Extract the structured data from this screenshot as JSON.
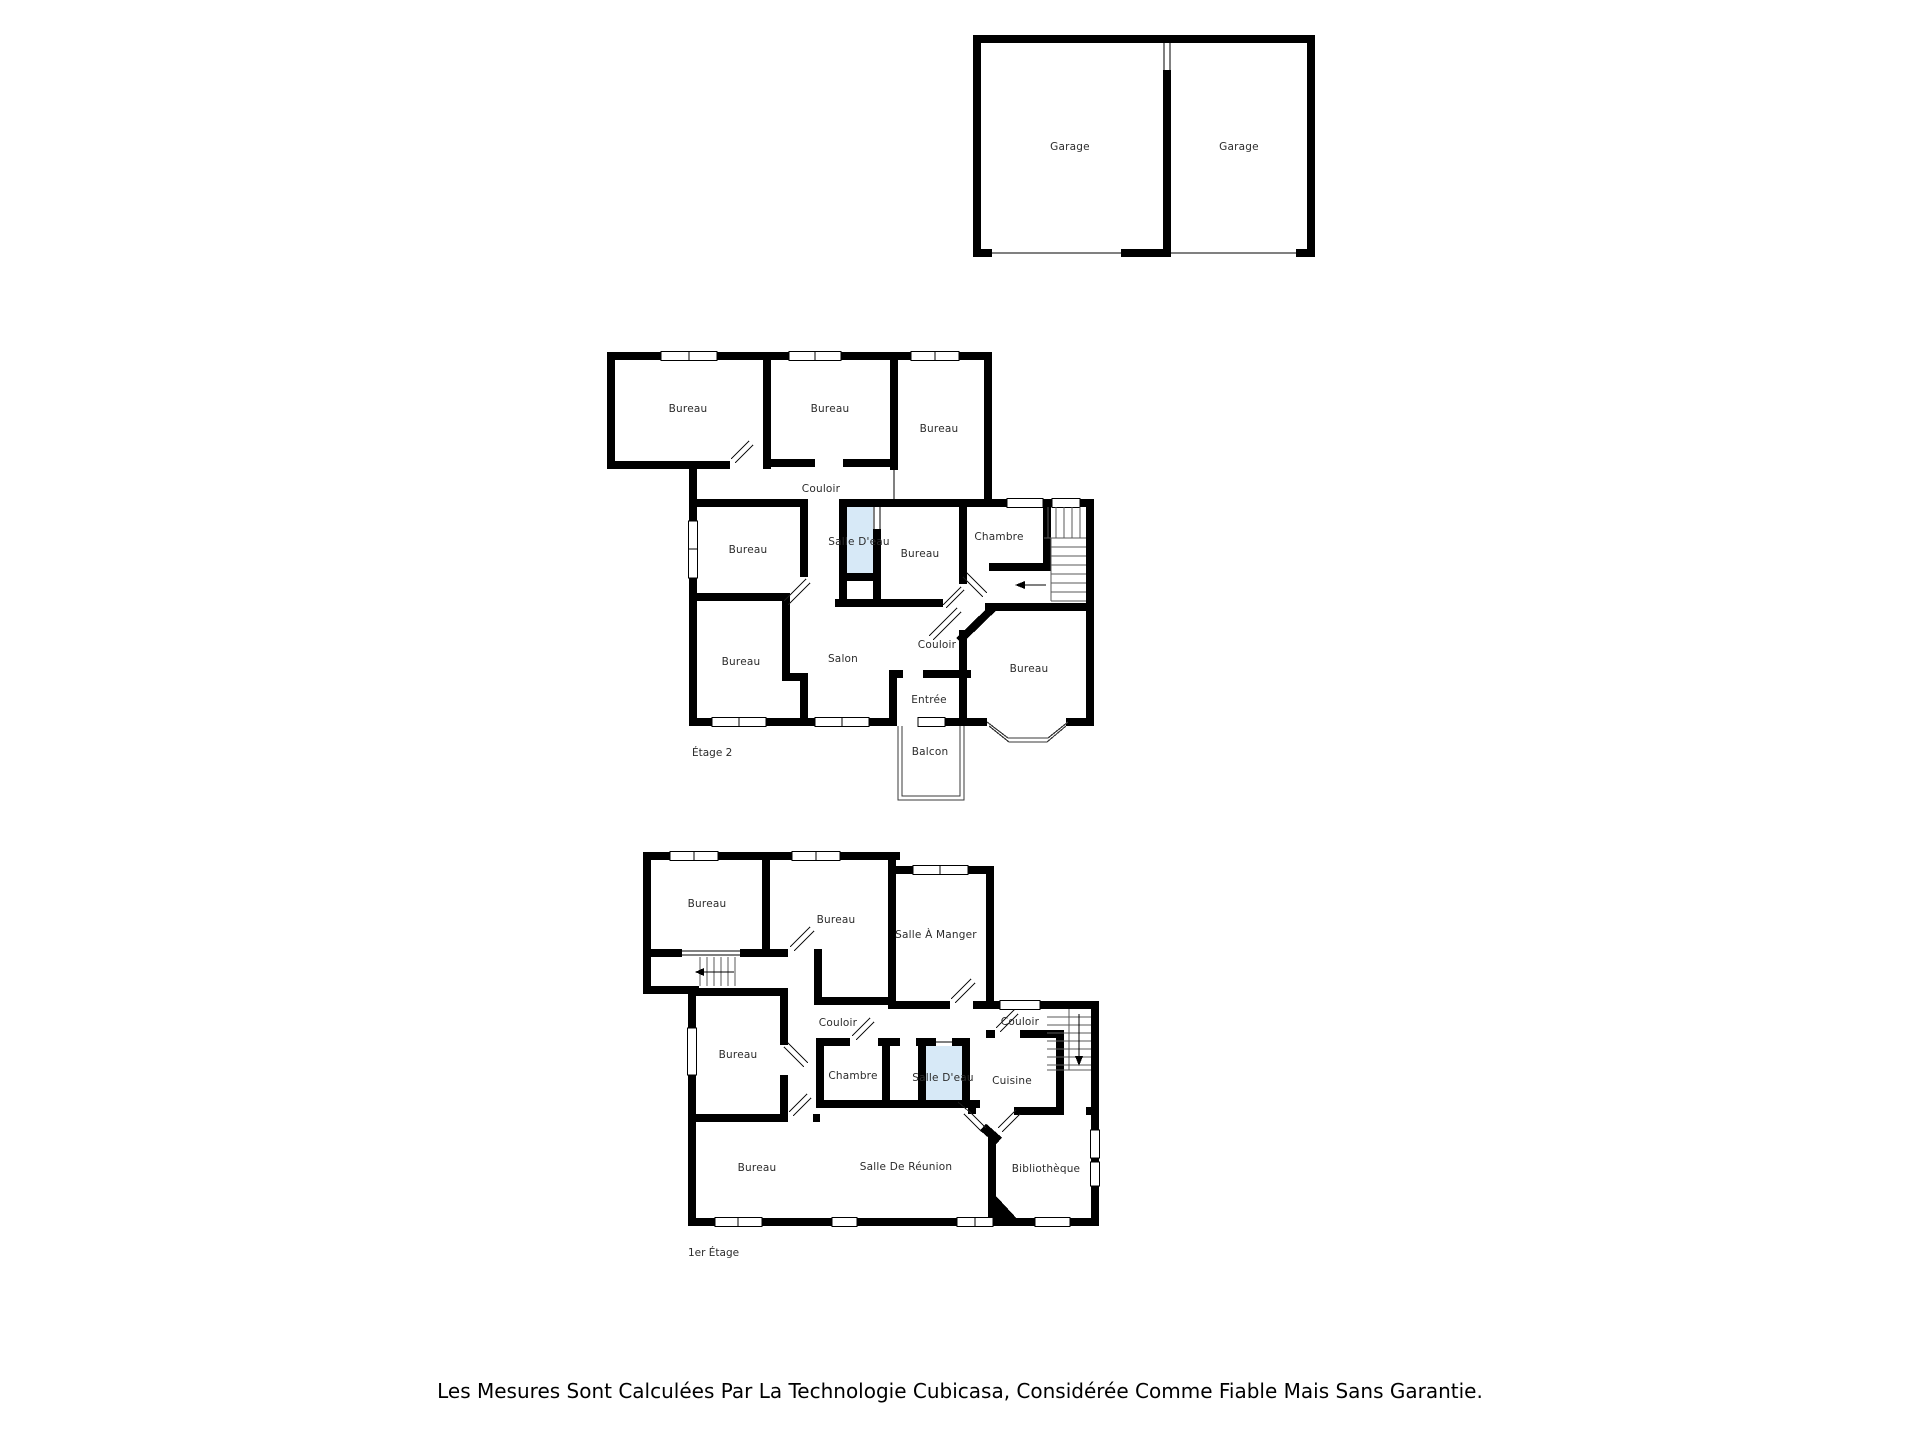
{
  "palette": {
    "wall": "#000000",
    "label_text": "#2b2b2b",
    "water_room_fill": "#d7e9f7",
    "background": "#ffffff"
  },
  "footer": {
    "disclaimer": "Les Mesures Sont Calculées Par La Technologie Cubicasa, Considérée Comme Fiable Mais Sans Garantie."
  },
  "floors": [
    {
      "id": "garage",
      "label": "",
      "rooms": [
        {
          "label": "Garage"
        },
        {
          "label": "Garage"
        }
      ]
    },
    {
      "id": "etage-2",
      "label": "Étage 2",
      "rooms": [
        {
          "label": "Bureau"
        },
        {
          "label": "Bureau"
        },
        {
          "label": "Bureau"
        },
        {
          "label": "Couloir"
        },
        {
          "label": "Bureau"
        },
        {
          "label": "Salle D'eau"
        },
        {
          "label": "Bureau"
        },
        {
          "label": "Chambre"
        },
        {
          "label": "Bureau"
        },
        {
          "label": "Salon"
        },
        {
          "label": "Couloir"
        },
        {
          "label": "Entrée"
        },
        {
          "label": "Bureau"
        },
        {
          "label": "Balcon"
        }
      ]
    },
    {
      "id": "premier-etage",
      "label": "1er Étage",
      "rooms": [
        {
          "label": "Bureau"
        },
        {
          "label": "Bureau"
        },
        {
          "label": "Salle À Manger"
        },
        {
          "label": "Couloir"
        },
        {
          "label": "Bureau"
        },
        {
          "label": "Chambre"
        },
        {
          "label": "Salle D'eau"
        },
        {
          "label": "Cuisine"
        },
        {
          "label": "Couloir"
        },
        {
          "label": "Bureau"
        },
        {
          "label": "Salle De Réunion"
        },
        {
          "label": "Bibliothèque"
        }
      ]
    }
  ]
}
